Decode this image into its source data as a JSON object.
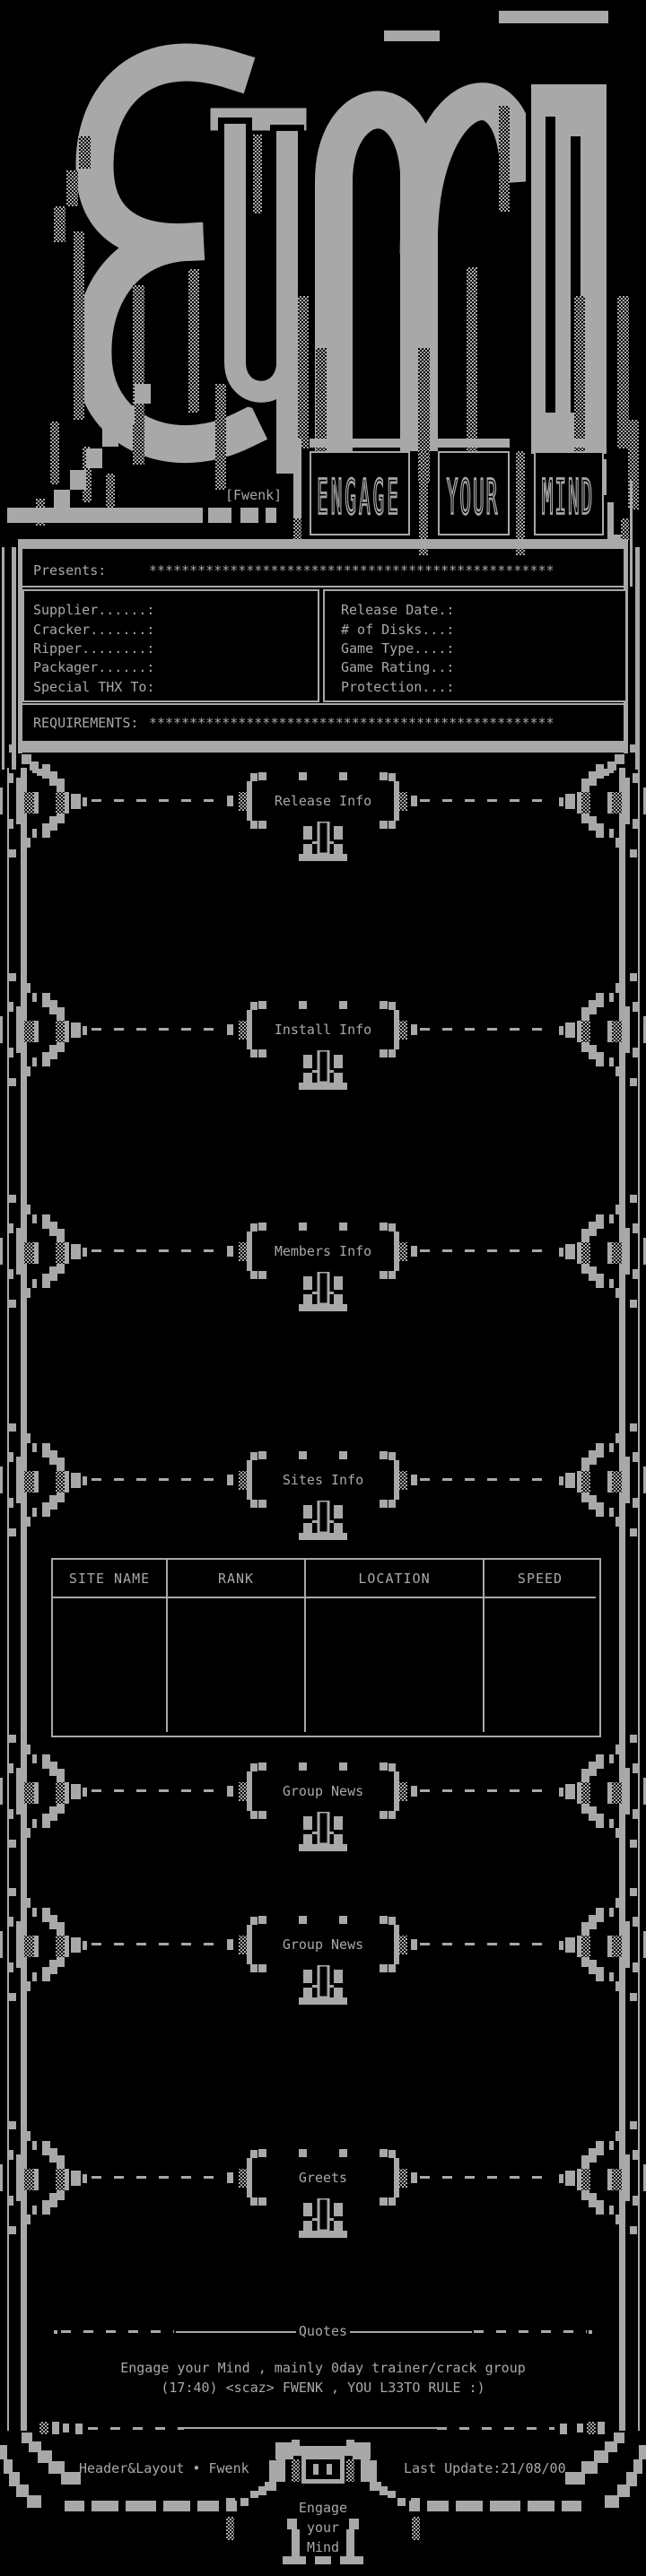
{
  "meta": {
    "fg_color": "#a8a8a8",
    "bg_color": "#000000"
  },
  "logo": {
    "group_name": "EYM",
    "handle_tag": "[Fwenk]",
    "banner_words": [
      "ENGAGE",
      "YOUR",
      "MIND"
    ]
  },
  "presents": {
    "label": "Presents:",
    "value": "**************************************************"
  },
  "release_fields": {
    "left": [
      {
        "label": "Supplier......:",
        "value": ""
      },
      {
        "label": "Cracker.......:",
        "value": ""
      },
      {
        "label": "Ripper........:",
        "value": ""
      },
      {
        "label": "Packager......:",
        "value": ""
      },
      {
        "label": "Special THX To:",
        "value": ""
      }
    ],
    "right": [
      {
        "label": "Release Date.:",
        "value": ""
      },
      {
        "label": "# of Disks...:",
        "value": ""
      },
      {
        "label": "Game Type....:",
        "value": ""
      },
      {
        "label": "Game Rating..:",
        "value": ""
      },
      {
        "label": "Protection...:",
        "value": ""
      }
    ]
  },
  "requirements": {
    "label": "REQUIREMENTS:",
    "value": "**************************************************"
  },
  "sections": [
    {
      "title": "Release Info"
    },
    {
      "title": "Install Info"
    },
    {
      "title": "Members Info"
    },
    {
      "title": "Sites Info"
    },
    {
      "title": "Group News"
    },
    {
      "title": "Group News"
    },
    {
      "title": "Greets"
    }
  ],
  "sites_table": {
    "headers": [
      "SITE NAME",
      "RANK",
      "LOCATION",
      "SPEED"
    ],
    "rows": []
  },
  "quotes": {
    "title": "Quotes",
    "lines": [
      "Engage your Mind , mainly 0day trainer/crack group",
      "(17:40) <scaz> FWENK , YOU L33TO RULE :)"
    ]
  },
  "footer": {
    "credit": "Header&Layout • Fwenk",
    "last_update": "Last Update:21/08/00",
    "emblem_words": [
      "Engage",
      "your",
      "Mind"
    ]
  }
}
